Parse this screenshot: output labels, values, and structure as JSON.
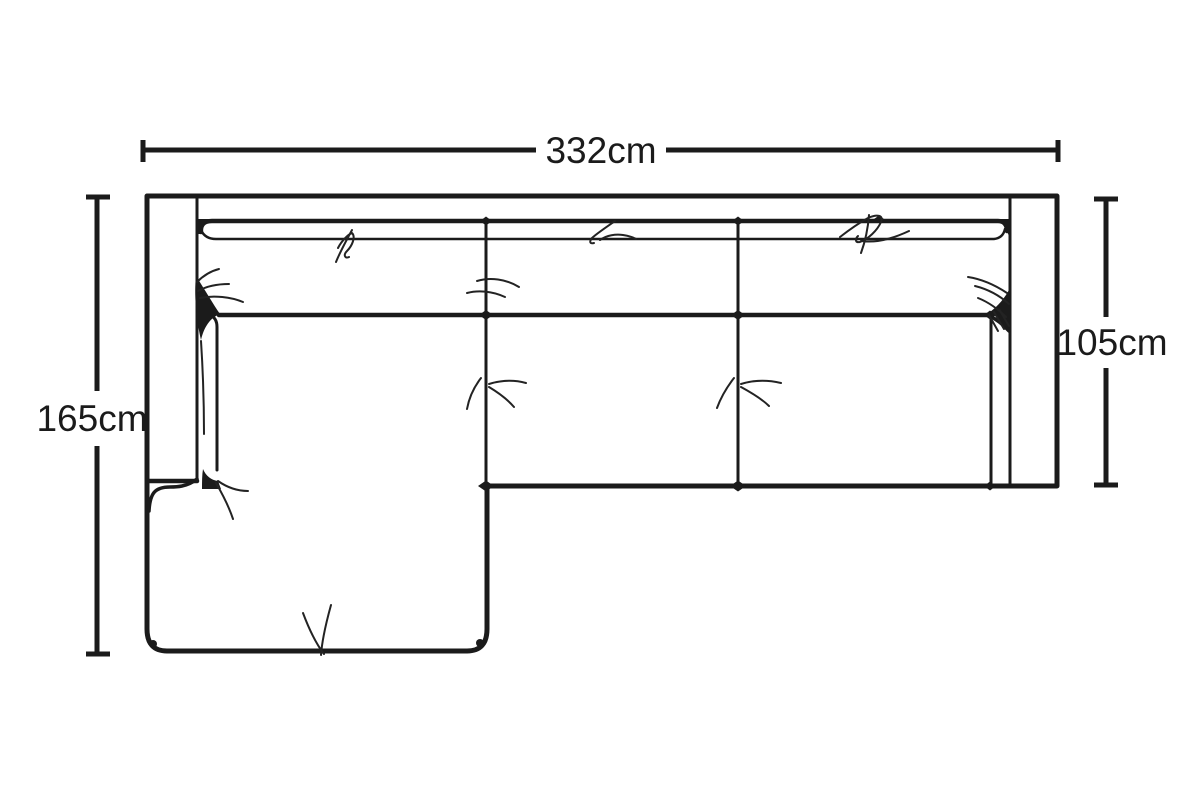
{
  "page": {
    "background_color": "#ffffff",
    "ink_color": "#1b1b1b"
  },
  "diagram": {
    "subject": "L-shaped chaise sofa, top view",
    "dimensions": {
      "overall_width": "332cm",
      "chaise_depth": "165cm",
      "seat_depth": "105cm"
    }
  }
}
